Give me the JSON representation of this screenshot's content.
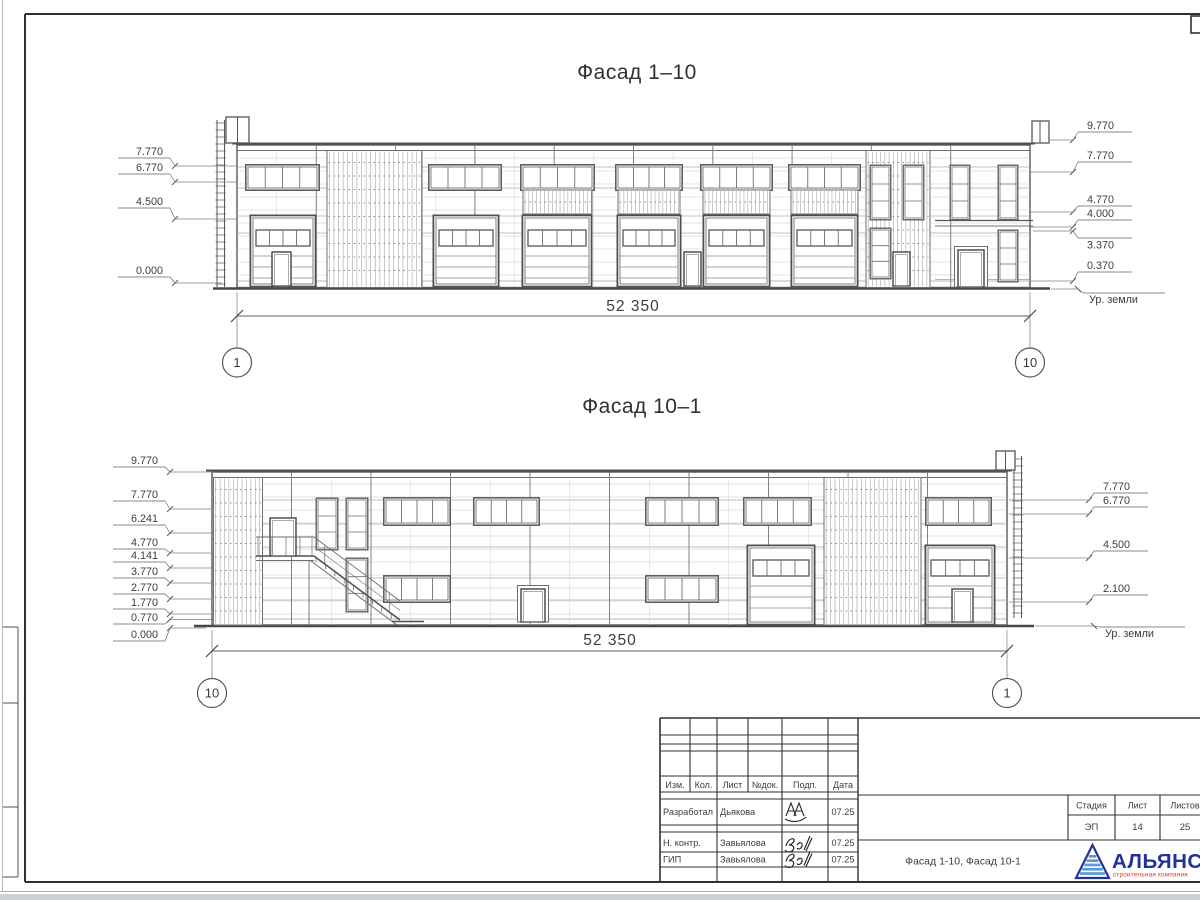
{
  "sheet": {
    "f1": {
      "title": "Фасад 1–10",
      "left_marks": [
        "7.770",
        "6.770",
        "4.500",
        "0.000"
      ],
      "right_marks": [
        "9.770",
        "7.770",
        "4.770",
        "4.000",
        "3.370",
        "0.370"
      ],
      "ground_label": "Ур. земли",
      "dim": "52 350",
      "axis_left": "1",
      "axis_right": "10"
    },
    "f2": {
      "title": "Фасад 10–1",
      "left_marks": [
        "9.770",
        "7.770",
        "6.241",
        "4.770",
        "4.141",
        "3.770",
        "2.770",
        "1.770",
        "0.770",
        "0.000"
      ],
      "right_marks": [
        "7.770",
        "6.770",
        "4.500",
        "2.100"
      ],
      "ground_label": "Ур. земли",
      "dim": "52 350",
      "axis_left": "10",
      "axis_right": "1"
    },
    "titleblock": {
      "cols": {
        "izm": "Изм.",
        "kol": "Кол.",
        "list": "Лист",
        "ndok": "№док.",
        "podp": "Подп.",
        "data": "Дата"
      },
      "rows": [
        {
          "role": "Разработал",
          "name": "Дьякова",
          "date": "07.25"
        },
        {
          "role": "Н. контр.",
          "name": "Завьялова",
          "date": "07.25"
        },
        {
          "role": "ГИП",
          "name": "Завьялова",
          "date": "07.25"
        }
      ],
      "stage_label": "Стадия",
      "sheet_label": "Лист",
      "sheets_label": "Листов",
      "stage": "ЭП",
      "sheet_no": "14",
      "sheets_total": "25",
      "doc_title": "Фасад 1-10, Фасад 10-1",
      "company": "АЛЬЯНС",
      "company_sub": "строительная компания"
    },
    "colors": {
      "brand_navy": "#24319b",
      "brand_blue": "#5b9bd5",
      "brand_red": "#d03a3a"
    }
  }
}
